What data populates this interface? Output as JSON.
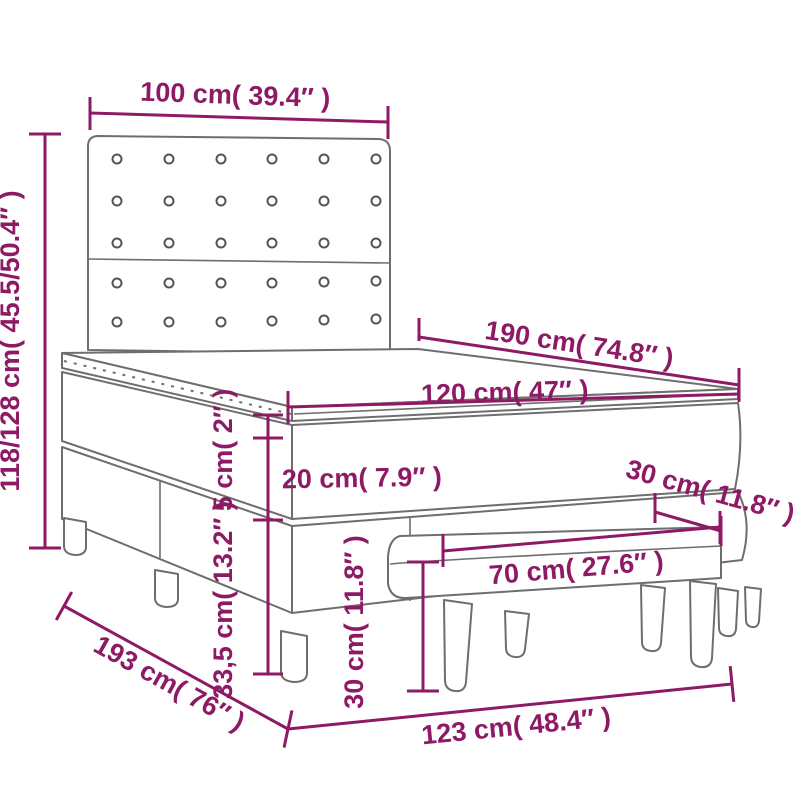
{
  "diagram": "box-spring-bed-with-bench-dimensions",
  "colors": {
    "dimension_accent": "#8E1A66",
    "furniture_outline": "#6E6E6E",
    "background": "#FFFFFF"
  },
  "dimensions": {
    "headboard_width": "100 cm( 39.4″ )",
    "total_height": "118/128 cm( 45.5/50.4″ )",
    "bed_length": "190 cm( 74.8″ )",
    "bed_width": "120 cm( 47″ )",
    "topper_height": "5 cm( 2″ )",
    "mattress_height": "20 cm( 7.9″ )",
    "base_height": "33,5 cm( 13.2″ )",
    "bench_height": "30 cm( 11.8″ )",
    "bench_width": "70 cm( 27.6″ )",
    "bench_depth": "30 cm( 11.8″ )",
    "floor_length": "193 cm( 76″ )",
    "floor_width": "123 cm( 48.4″ )"
  }
}
